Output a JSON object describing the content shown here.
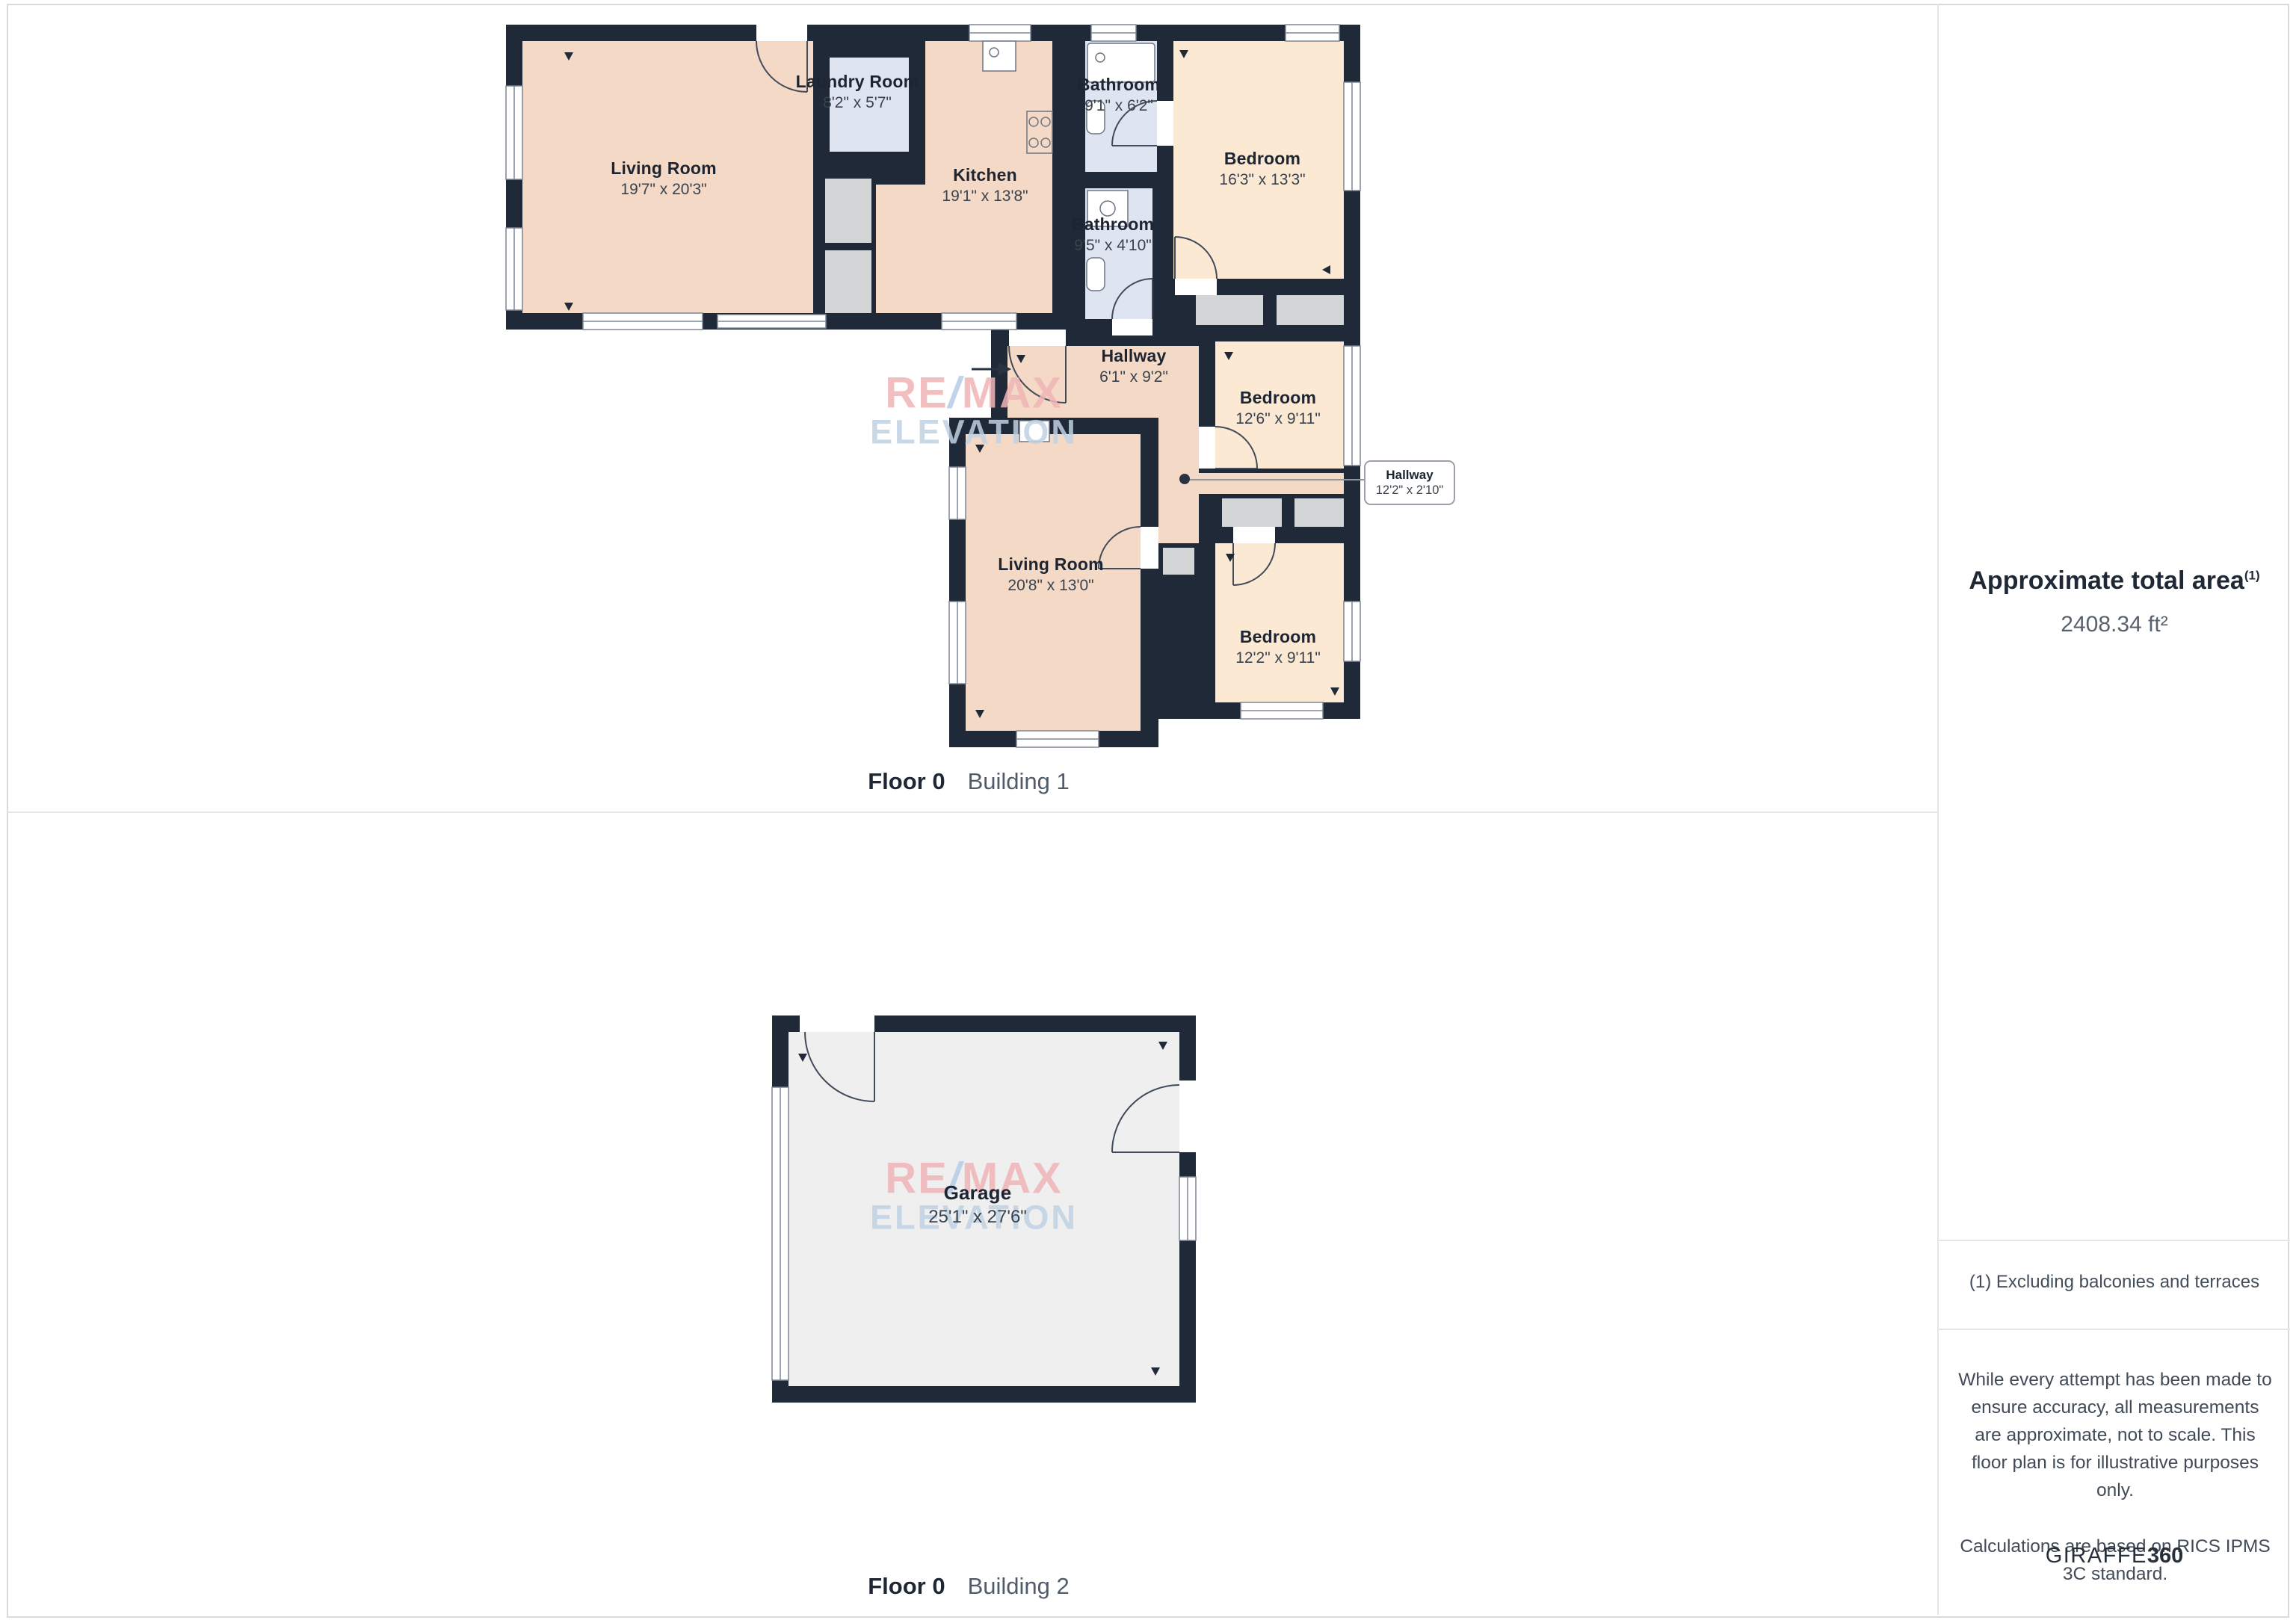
{
  "floor1": {
    "floor_label": "Floor 0",
    "building_label": "Building 1",
    "rooms": {
      "living1": {
        "name": "Living Room",
        "dims": "19'7\" x 20'3\""
      },
      "laundry": {
        "name": "Laundry Room",
        "dims": "8'2\" x 5'7\""
      },
      "kitchen": {
        "name": "Kitchen",
        "dims": "19'1\" x 13'8\""
      },
      "bath1": {
        "name": "Bathroom",
        "dims": "9'1\" x 6'2\""
      },
      "bedroom1": {
        "name": "Bedroom",
        "dims": "16'3\" x 13'3\""
      },
      "bath2": {
        "name": "Bathroom",
        "dims": "9'5\" x 4'10\""
      },
      "hallway1": {
        "name": "Hallway",
        "dims": "6'1\" x 9'2\""
      },
      "bedroom2": {
        "name": "Bedroom",
        "dims": "12'6\" x 9'11\""
      },
      "hallway2": {
        "name": "Hallway",
        "dims": "12'2\" x 2'10\""
      },
      "living2": {
        "name": "Living Room",
        "dims": "20'8\" x 13'0\""
      },
      "bedroom3": {
        "name": "Bedroom",
        "dims": "12'2\" x 9'11\""
      }
    }
  },
  "floor2": {
    "floor_label": "Floor 0",
    "building_label": "Building 2",
    "rooms": {
      "garage": {
        "name": "Garage",
        "dims": "25'1\" x 27'6\""
      }
    }
  },
  "sidebar": {
    "area_title": "Approximate total area",
    "area_sup": "(1)",
    "area_value": "2408.34 ft²",
    "note": "(1) Excluding balconies and terraces",
    "disclaimer1": "While every attempt has been made to ensure accuracy, all measurements are approximate, not to scale. This floor plan is for illustrative purposes only.",
    "disclaimer2": "Calculations are based on RICS IPMS 3C standard.",
    "brand_name": "GIRAFFE",
    "brand_number": "360"
  },
  "watermark": {
    "re": "RE",
    "slash": "/",
    "max": "MAX",
    "line2": "ELEVATION"
  },
  "colors": {
    "wall": "#1f2937",
    "room_warm": "#f3d9c6",
    "room_light": "#fbe9d4",
    "room_blue": "#dfe5f0",
    "closet_gray": "#d4d5d7",
    "garage_gray": "#efeff0",
    "watermark_pink": "#f0b5b7",
    "watermark_blue": "#b5cce7"
  }
}
